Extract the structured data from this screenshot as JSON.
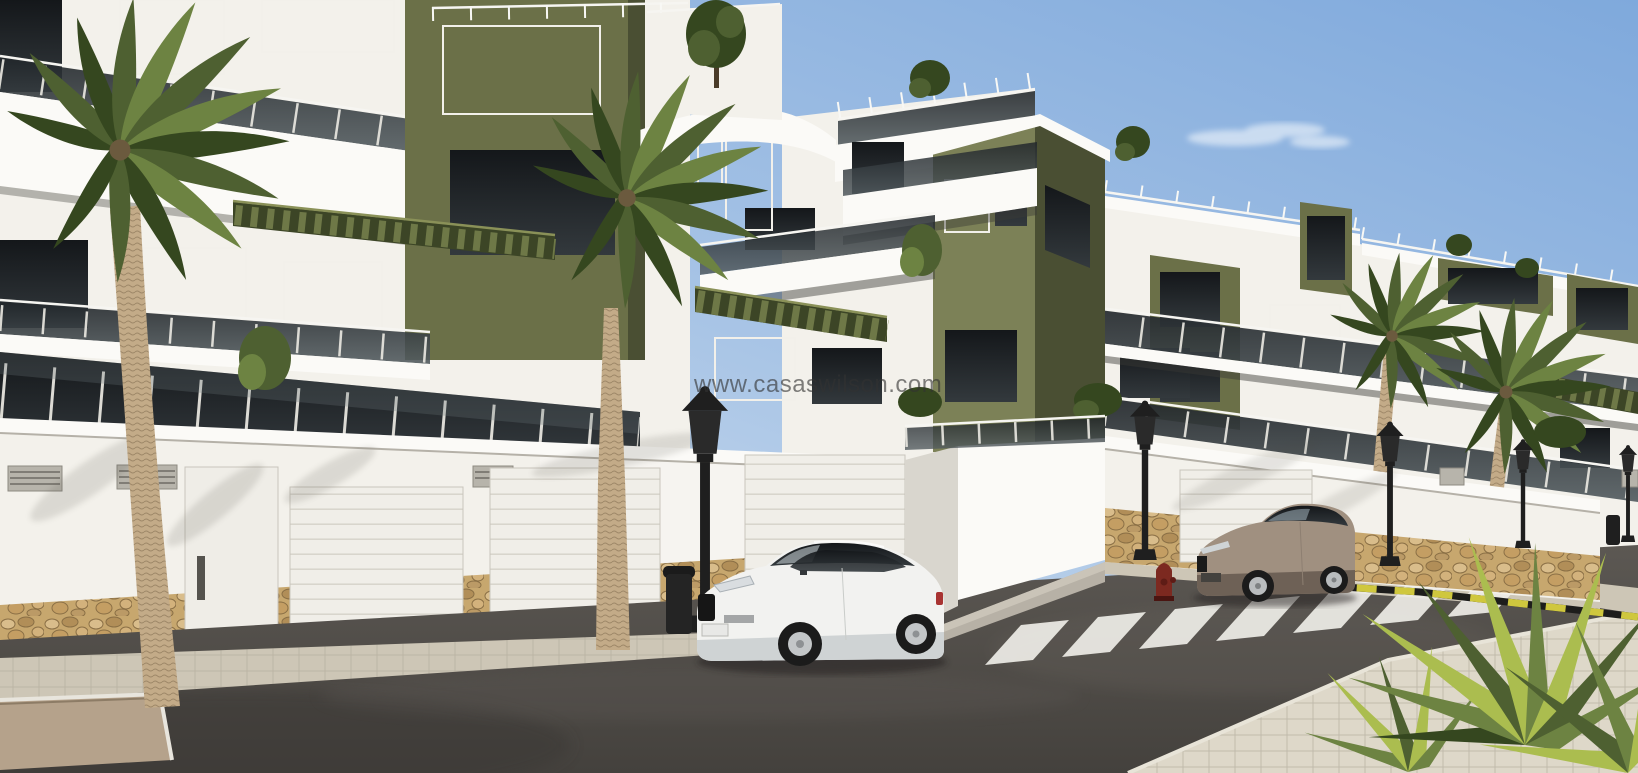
{
  "image": {
    "width": 1638,
    "height": 773,
    "kind": "3d-architectural-render-photo"
  },
  "watermark": {
    "text": "www.casaswilson.com"
  },
  "scene": {
    "subject": "new-build white apartment complex with olive-green accent walls",
    "elements": [
      "apartment-buildings",
      "rooftop-terraces",
      "glass-balconies",
      "pergolas",
      "palm-trees",
      "street-wall-with-garage-doors",
      "stone-base-wall",
      "sidewalk",
      "asphalt-road",
      "zebra-crosswalk",
      "yellow-black-curb-marking",
      "white-sports-coupe",
      "beige-coupe",
      "street-lamps",
      "litter-bins",
      "fire-hydrant"
    ]
  },
  "palette": {
    "sky-top": "#7fa9dc",
    "sky-horizon": "#d3e2f0",
    "cloud": "#f2f7fc",
    "facade": "#f3f1eb",
    "facade-shade": "#d9d6ce",
    "facade-dark": "#c4c1b9",
    "cornice": "#fbfaf7",
    "olive": "#6b7048",
    "olive-lit": "#7c8157",
    "olive-dark": "#4a4f33",
    "pergola": "#3c4526",
    "glass": "#262c2f",
    "stone": "#c7a76e",
    "stone-joint": "#8a6f45",
    "sidewalk": "#cdc6b6",
    "sidewalk-lit": "#ded8c9",
    "road": "#514d49",
    "road-dark": "#403d3a",
    "stripe": "#eeede7",
    "curb-yellow": "#cfc73e",
    "curb-black": "#1d1d1b",
    "palm": "#4e6031",
    "palm-dark": "#35471f",
    "palm-lit": "#6d8342",
    "palm-yellow": "#abbd4f",
    "trunk": "#c3ab88",
    "trunk-dark": "#93785a",
    "car-white": "#f2f2f0",
    "car-beige": "#a09080",
    "metal": "#1f1f1f",
    "hydrant": "#7c2920",
    "watermark": "rgba(50,50,50,0.62)"
  }
}
